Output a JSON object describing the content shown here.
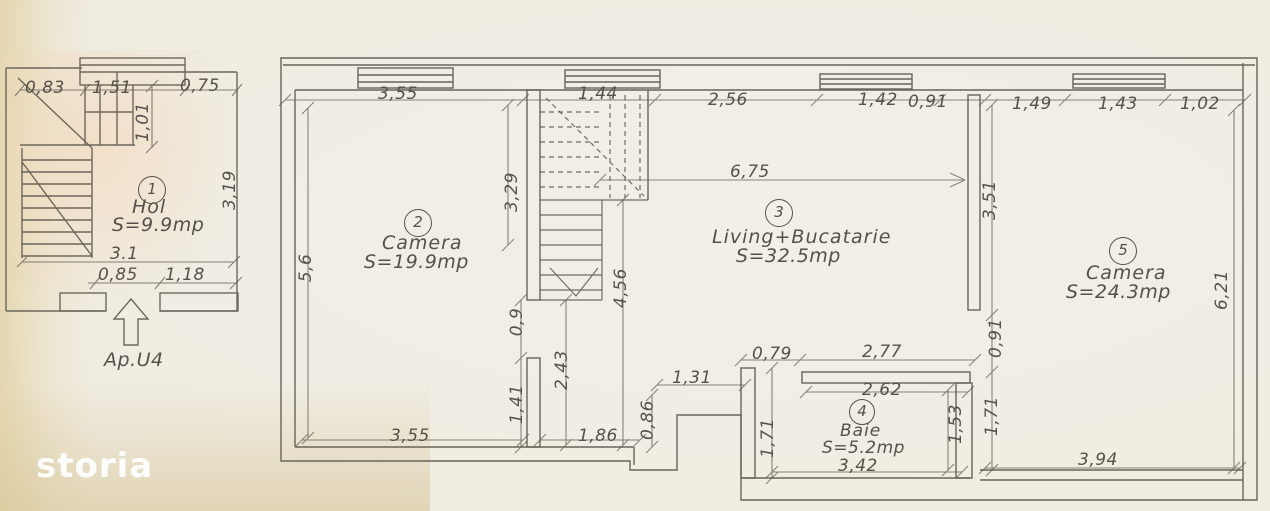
{
  "watermark": "storia",
  "hall_plan": {
    "number": "1",
    "name": "Hol",
    "area": "S=9.9mp",
    "entrance_label": "Ap.U4",
    "dims": {
      "top": [
        "0,83",
        "1,51",
        "0,75"
      ],
      "window_height": "1,01",
      "right": "3,19",
      "width": "3.1",
      "bottom": [
        "0,85",
        "1,18"
      ]
    }
  },
  "apartment_plan": {
    "rooms": {
      "camera2": {
        "number": "2",
        "name": "Camera",
        "area": "S=19.9mp"
      },
      "living": {
        "number": "3",
        "name": "Living+Bucatarie",
        "area": "S=32.5mp"
      },
      "baie": {
        "number": "4",
        "name": "Baie",
        "area": "S=5.2mp"
      },
      "camera5": {
        "number": "5",
        "name": "Camera",
        "area": "S=24.3mp"
      }
    },
    "dims": {
      "top": [
        "3,55",
        "1,44",
        "2,56",
        "1,42",
        "0,91",
        "1,49",
        "1,43",
        "1,02"
      ],
      "left": "5,6",
      "camera2_right": [
        "3,29",
        "0,9",
        "1,41"
      ],
      "stair_depth": "2,43",
      "living_depth": "4,56",
      "living_width": "6,75",
      "living_right": [
        "3,51",
        "0,91"
      ],
      "camera5_right": "6,21",
      "bottom_left": "3,55",
      "bottom_mid": [
        "1,86",
        "0,86",
        "1,31"
      ],
      "bath_top": [
        "0,79",
        "2,77"
      ],
      "bath_inner_top": "2,62",
      "bath_left": "1,71",
      "bath_right": [
        "1,53",
        "1,71"
      ],
      "bath_bottom": "3,42",
      "camera5_bottom": "3,94"
    }
  }
}
